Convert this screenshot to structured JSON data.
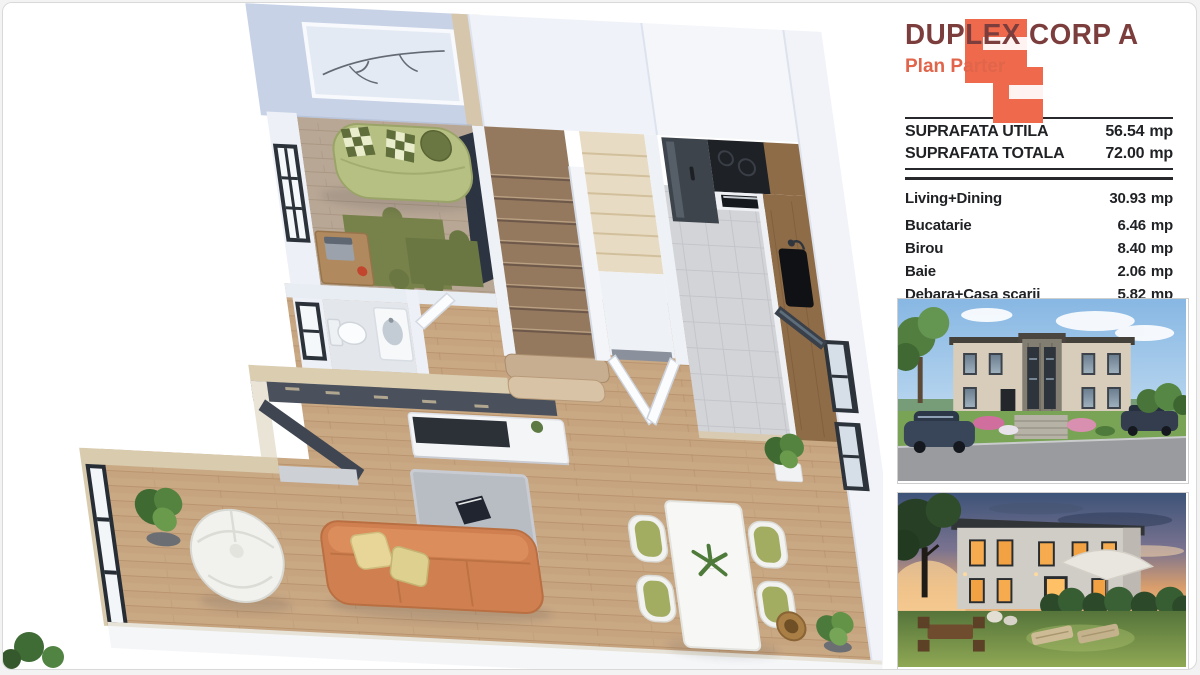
{
  "header": {
    "title": "DUPLEX CORP A",
    "subtitle": "Plan Parter",
    "title_color": "#7c3e3c",
    "accent_color": "#e3654a",
    "logo_color": "#ef6a4d"
  },
  "summary": [
    {
      "label": "SUPRAFATA UTILA",
      "value": "56.54",
      "unit": "mp"
    },
    {
      "label": "SUPRAFATA TOTALA",
      "value": "72.00",
      "unit": "mp"
    }
  ],
  "rooms": [
    {
      "label": "Living+Dining",
      "value": "30.93",
      "unit": "mp"
    },
    {
      "label": "Bucatarie",
      "value": "6.46",
      "unit": "mp"
    },
    {
      "label": "Birou",
      "value": "8.40",
      "unit": "mp"
    },
    {
      "label": "Baie",
      "value": "2.06",
      "unit": "mp"
    },
    {
      "label": "Debara+Casa scarii",
      "value": "5.82",
      "unit": "mp"
    },
    {
      "label": "Hol",
      "value": "2.87",
      "unit": "mp"
    }
  ],
  "floorplan": {
    "name": "plan-parter-3d-render",
    "colors": {
      "wood_floor": "#c6a480",
      "office_floor": "#b9a795",
      "walls": "#edf0f6",
      "tall_wall": "#c7d2e7",
      "kitchen_tile": "#d3d4d8",
      "sofa_orange": "#d08050",
      "sofa_green": "#b7c083",
      "rug_olive": "#77814a",
      "counter_wood": "#8f6c48",
      "appliance_black": "#1e2126",
      "frame_black": "#272d34",
      "cap_beige": "#dbcdb0"
    }
  },
  "photos": [
    {
      "name": "exterior-front-day"
    },
    {
      "name": "exterior-back-dusk"
    }
  ]
}
